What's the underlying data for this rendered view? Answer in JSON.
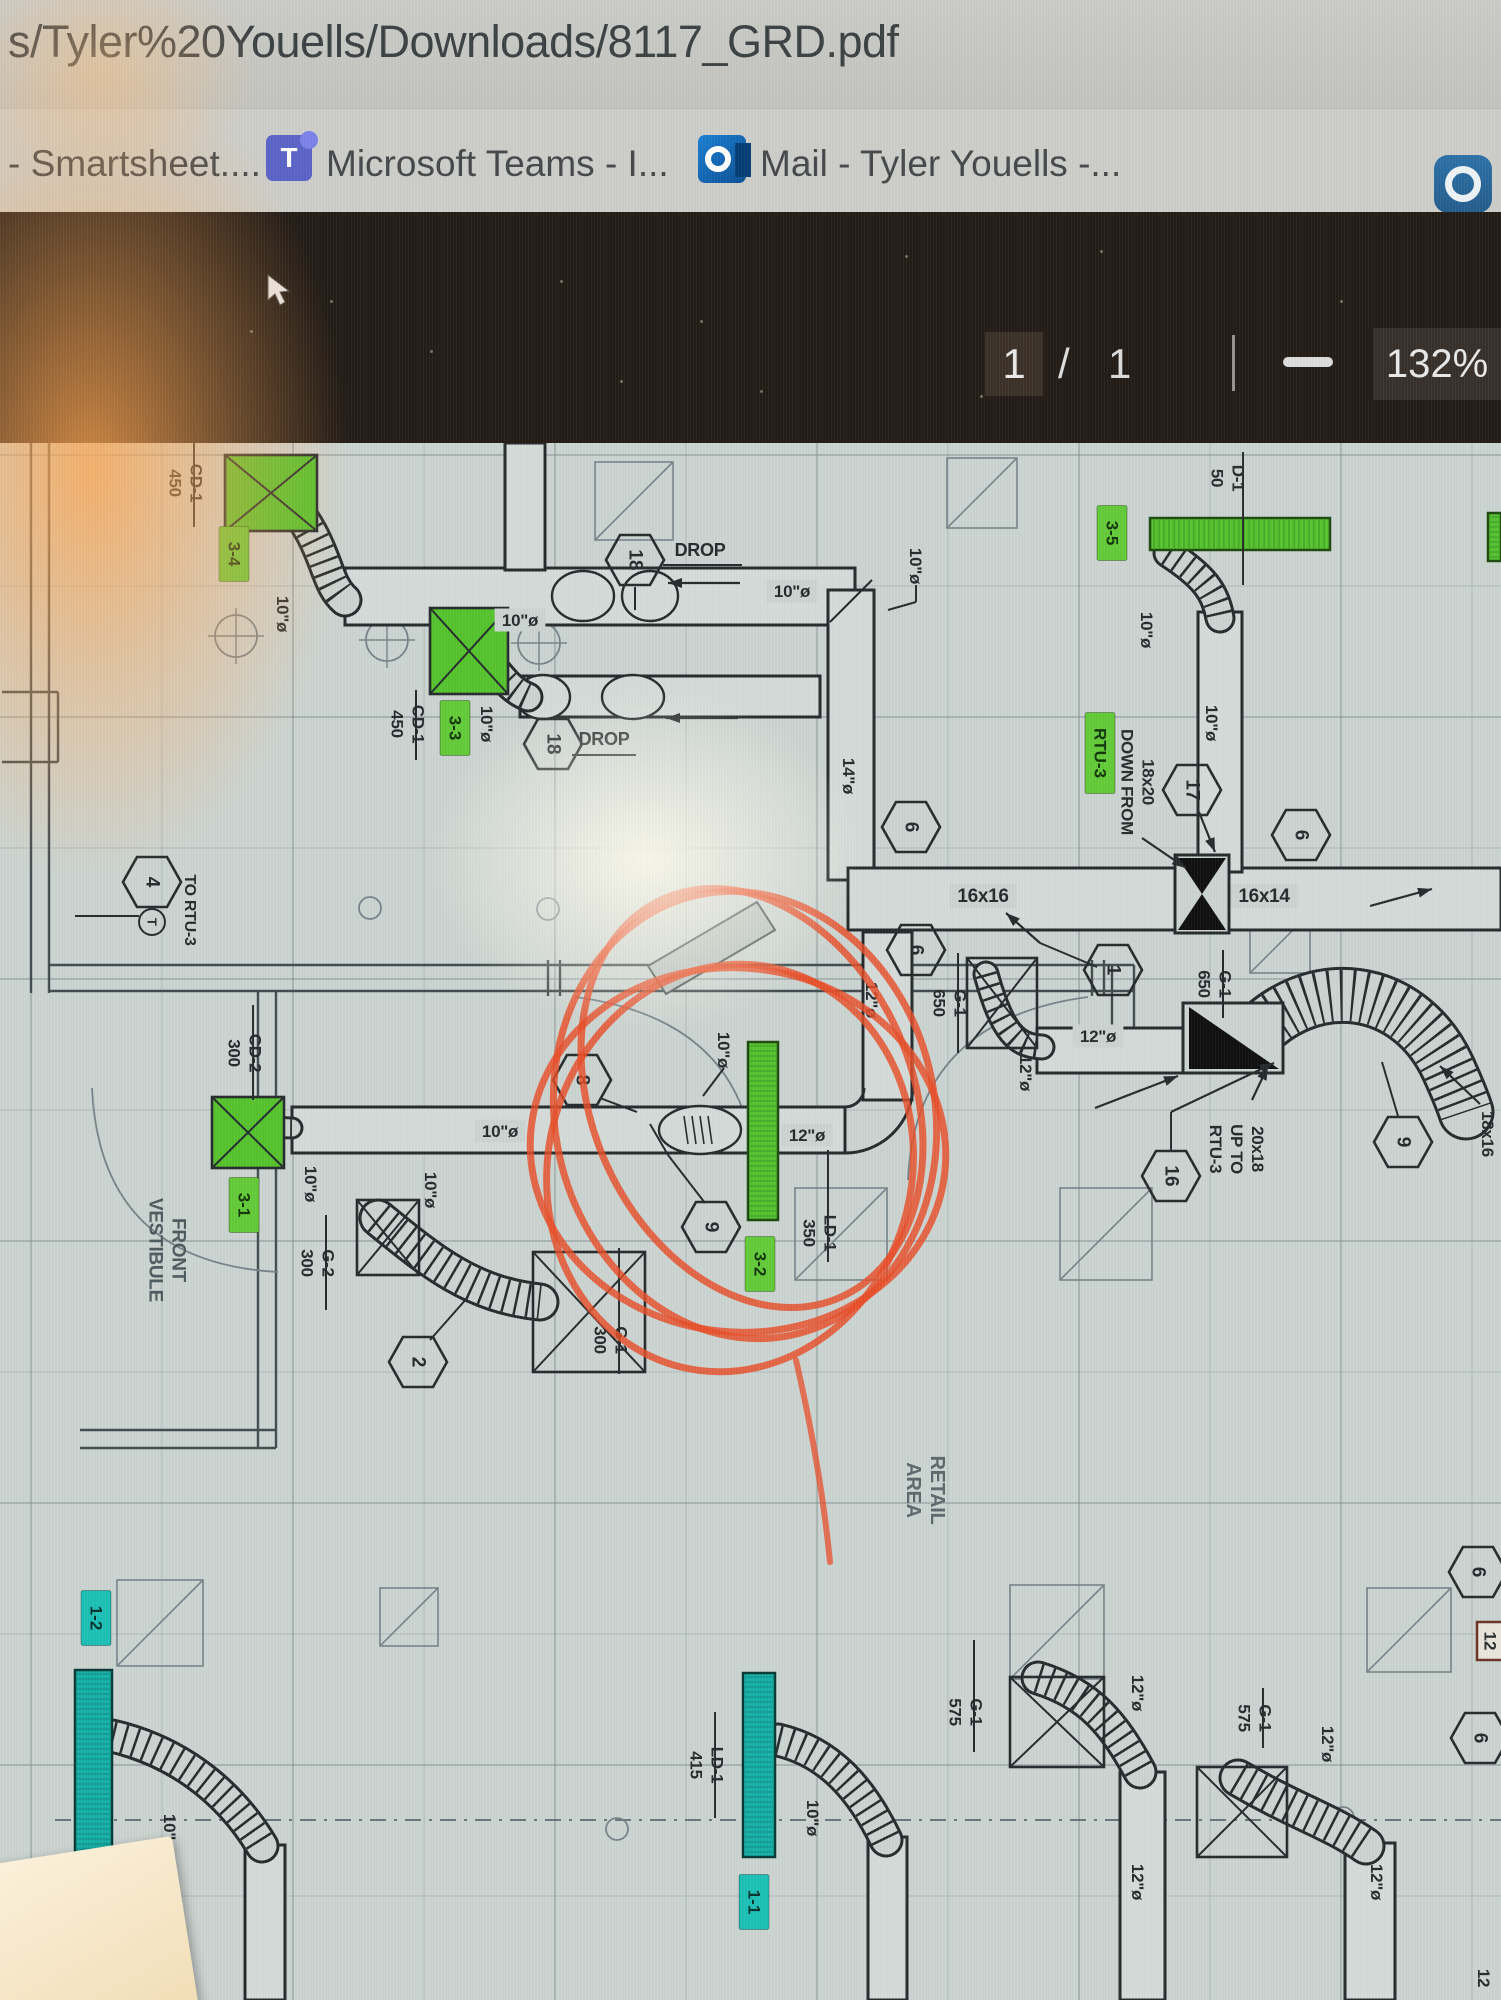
{
  "browser": {
    "url": "s/Tyler%20Youells/Downloads/8117_GRD.pdf"
  },
  "bookmarks": {
    "items": [
      {
        "label": "- Smartsheet....",
        "icon": "none"
      },
      {
        "label": "Microsoft Teams - I...",
        "icon": "teams-icon"
      },
      {
        "label": "Mail - Tyler Youells -...",
        "icon": "outlook-icon"
      }
    ],
    "right_icon": "app-ring-icon"
  },
  "pdf_toolbar": {
    "page_current": "1",
    "page_separator": "/",
    "page_total": "1",
    "zoom_out_label": "",
    "zoom_level": "132%"
  },
  "plan": {
    "colors": {
      "ink": "#262b2d",
      "paper": "#ccd4d1",
      "duct": "#d4dbd8",
      "green": "#55c32e",
      "greenChip": "#63cb39",
      "teal": "#16b1a8",
      "tealChip": "#1cc0b6",
      "red": "#e84e28",
      "gray": "#5c696d",
      "gray2": "#4d5a5e",
      "wall": "#414c4f",
      "grid": "#7d8b8e",
      "light": "#76848a"
    },
    "grid": {
      "x0": 31,
      "y0": 455,
      "step": 131,
      "nx": 12,
      "ny": 12
    },
    "labels": [
      {
        "t": "CD-1\n450",
        "x": 186,
        "y": 483,
        "r": 90,
        "dv": [
          441,
          527
        ]
      },
      {
        "t": "10\"ø",
        "x": 283,
        "y": 614,
        "r": 90
      },
      {
        "t": "DROP",
        "x": 700,
        "y": 550,
        "s": 18
      },
      {
        "t": "10\"ø",
        "x": 520,
        "y": 620,
        "bg": 1
      },
      {
        "t": "CD-1\n450",
        "x": 408,
        "y": 724,
        "r": 90,
        "dv": [
          690,
          760
        ]
      },
      {
        "t": "10\"ø",
        "x": 487,
        "y": 724,
        "r": 90
      },
      {
        "t": "DROP",
        "x": 604,
        "y": 739,
        "s": 18
      },
      {
        "t": "10\"ø",
        "x": 792,
        "y": 591,
        "bg": 1
      },
      {
        "t": "10\"ø",
        "x": 916,
        "y": 566,
        "r": 90
      },
      {
        "t": "14\"ø",
        "x": 849,
        "y": 776,
        "r": 90
      },
      {
        "t": "D-1\n50",
        "x": 1228,
        "y": 478,
        "r": 90
      },
      {
        "t": "10\"ø",
        "x": 1147,
        "y": 630,
        "r": 90
      },
      {
        "t": "10\"ø",
        "x": 1212,
        "y": 723,
        "r": 90
      },
      {
        "t": "18x20\nDOWN FROM",
        "x": 1138,
        "y": 782,
        "r": 90
      },
      {
        "t": "16x16",
        "x": 983,
        "y": 896,
        "s": 19,
        "bg": 1
      },
      {
        "t": "16x14",
        "x": 1264,
        "y": 896,
        "s": 19,
        "bg": 1
      },
      {
        "t": "G-1\n650",
        "x": 950,
        "y": 1003,
        "r": 90,
        "dv": [
          953,
          1053
        ]
      },
      {
        "t": "G-1\n650",
        "x": 1215,
        "y": 984,
        "r": 90,
        "dv": [
          950,
          1018
        ]
      },
      {
        "t": "12\"ø",
        "x": 1098,
        "y": 1036,
        "bg": 1
      },
      {
        "t": "12\"ø",
        "x": 1026,
        "y": 1073,
        "r": 90
      },
      {
        "t": "12\"ø",
        "x": 872,
        "y": 1000,
        "r": 90
      },
      {
        "t": "20x18\nUP TO\nRTU-3",
        "x": 1237,
        "y": 1149,
        "r": 90
      },
      {
        "t": "18x16",
        "x": 1488,
        "y": 1134,
        "r": 90
      },
      {
        "t": "TO RTU-3",
        "x": 190,
        "y": 910,
        "r": 90,
        "s": 16
      },
      {
        "t": "CD-2\n300",
        "x": 245,
        "y": 1053,
        "r": 90,
        "dv": [
          1005,
          1100
        ]
      },
      {
        "t": "FRONT\nVESTIBULE",
        "x": 167,
        "y": 1250,
        "r": 90,
        "s": 19,
        "c": "gray2"
      },
      {
        "t": "10\"ø",
        "x": 500,
        "y": 1131,
        "bg": 1
      },
      {
        "t": "10\"ø",
        "x": 311,
        "y": 1184,
        "r": 90
      },
      {
        "t": "G-2\n300",
        "x": 318,
        "y": 1263,
        "r": 90,
        "dv": [
          1215,
          1310
        ]
      },
      {
        "t": "10\"ø",
        "x": 431,
        "y": 1190,
        "r": 90
      },
      {
        "t": "10\"ø",
        "x": 724,
        "y": 1050,
        "r": 90
      },
      {
        "t": "12\"ø",
        "x": 807,
        "y": 1135,
        "bg": 1
      },
      {
        "t": "LD-1\n350",
        "x": 820,
        "y": 1233,
        "r": 90,
        "dv": [
          1150,
          1262
        ]
      },
      {
        "t": "G-1\n300",
        "x": 611,
        "y": 1340,
        "r": 90,
        "dv": [
          1248,
          1374
        ]
      },
      {
        "t": "RETAIL\nAREA",
        "x": 925,
        "y": 1490,
        "r": 90,
        "s": 20,
        "c": "gray"
      },
      {
        "t": "10\"ø",
        "x": 170,
        "y": 1832,
        "r": 90
      },
      {
        "t": "LD-1\n415",
        "x": 707,
        "y": 1765,
        "r": 90,
        "dv": [
          1712,
          1818
        ]
      },
      {
        "t": "10\"ø",
        "x": 813,
        "y": 1818,
        "r": 90
      },
      {
        "t": "G-1\n575",
        "x": 966,
        "y": 1712,
        "r": 90,
        "dv": [
          1640,
          1752
        ]
      },
      {
        "t": "12\"ø",
        "x": 1138,
        "y": 1693,
        "r": 90
      },
      {
        "t": "12\"ø",
        "x": 1138,
        "y": 1882,
        "r": 90
      },
      {
        "t": "G-1\n575",
        "x": 1255,
        "y": 1718,
        "r": 90,
        "dv": [
          1688,
          1748
        ]
      },
      {
        "t": "12\"ø",
        "x": 1328,
        "y": 1744,
        "r": 90
      },
      {
        "t": "12\"ø",
        "x": 1377,
        "y": 1882,
        "r": 90
      },
      {
        "t": "12",
        "x": 1484,
        "y": 1978,
        "r": 90
      }
    ],
    "chips": [
      {
        "t": "3-4",
        "x": 234,
        "y": 554
      },
      {
        "t": "3-3",
        "x": 455,
        "y": 728
      },
      {
        "t": "3-5",
        "x": 1112,
        "y": 533
      },
      {
        "t": "RTU-3",
        "x": 1100,
        "y": 753
      },
      {
        "t": "3-1",
        "x": 244,
        "y": 1205
      },
      {
        "t": "3-2",
        "x": 760,
        "y": 1264
      },
      {
        "t": "1-2",
        "x": 96,
        "y": 1618,
        "k": "teal"
      },
      {
        "t": "1-1",
        "x": 754,
        "y": 1902,
        "k": "teal"
      }
    ],
    "hexagons": [
      {
        "n": "18",
        "x": 635,
        "y": 560
      },
      {
        "n": "18",
        "x": 553,
        "y": 744
      },
      {
        "n": "17",
        "x": 1192,
        "y": 790
      },
      {
        "n": "6",
        "x": 1301,
        "y": 835
      },
      {
        "n": "6",
        "x": 911,
        "y": 827
      },
      {
        "n": "6",
        "x": 916,
        "y": 950
      },
      {
        "n": "1",
        "x": 1113,
        "y": 970
      },
      {
        "n": "16",
        "x": 1171,
        "y": 1176
      },
      {
        "n": "9",
        "x": 1403,
        "y": 1142
      },
      {
        "n": "4",
        "x": 152,
        "y": 882
      },
      {
        "n": "8",
        "x": 582,
        "y": 1080
      },
      {
        "n": "9",
        "x": 711,
        "y": 1227
      },
      {
        "n": "2",
        "x": 418,
        "y": 1362
      },
      {
        "n": "6",
        "x": 1480,
        "y": 1738
      },
      {
        "n": "6",
        "x": 1478,
        "y": 1572
      }
    ],
    "boxed_labels": [
      {
        "t": "12",
        "x": 1477,
        "y": 1622,
        "w": 26,
        "h": 38
      }
    ],
    "green_squares": [
      [
        225,
        455,
        92,
        76
      ],
      [
        430,
        608,
        78,
        86
      ],
      [
        212,
        1097,
        72,
        71
      ]
    ],
    "white_squares": [
      [
        967,
        958,
        70,
        90
      ],
      [
        357,
        1200,
        62,
        75
      ],
      [
        533,
        1252,
        112,
        120
      ],
      [
        1010,
        1677,
        94,
        90
      ],
      [
        1197,
        1767,
        90,
        90
      ]
    ],
    "green_bars": [
      [
        1150,
        518,
        180,
        32
      ],
      [
        1488,
        513,
        13,
        48
      ],
      [
        748,
        1042,
        30,
        178
      ]
    ],
    "teal_bars": [
      [
        75,
        1670,
        37,
        187
      ],
      [
        743,
        1673,
        32,
        184
      ]
    ],
    "ducts": [
      [
        345,
        568,
        510,
        57
      ],
      [
        520,
        676,
        300,
        41
      ],
      [
        828,
        590,
        46,
        290
      ],
      [
        848,
        868,
        653,
        62
      ],
      [
        1198,
        612,
        44,
        260
      ],
      [
        1037,
        1028,
        146,
        45
      ],
      [
        292,
        1107,
        553,
        46
      ],
      [
        863,
        932,
        49,
        168
      ],
      [
        245,
        1845,
        40,
        155
      ],
      [
        868,
        1837,
        39,
        163
      ],
      [
        1120,
        1772,
        45,
        228
      ],
      [
        1345,
        1843,
        50,
        157
      ],
      [
        505,
        443,
        40,
        127
      ]
    ],
    "elbow_paths": [
      "M845,1153 A68,68 0 0 0 913,1085",
      "M845,1107 A19,19 0 0 0 864,1088"
    ],
    "ovals": [
      [
        583,
        596,
        31,
        25
      ],
      [
        650,
        596,
        28,
        25
      ],
      [
        543,
        697,
        27,
        22
      ],
      [
        633,
        697,
        31,
        22
      ],
      [
        700,
        1130,
        41,
        24,
        1
      ]
    ],
    "flex": [
      {
        "d": "M282,492 C330,545 322,580 345,600",
        "w": 30
      },
      {
        "d": "M468,638 C498,668 505,688 528,697",
        "w": 26
      },
      {
        "d": "M1168,553 C1205,577 1215,592 1220,618",
        "w": 26
      },
      {
        "d": "M986,974 C1002,1032 1016,1046 1042,1047",
        "w": 22
      },
      {
        "d": "M378,1218 C432,1262 472,1295 540,1302",
        "w": 34
      },
      {
        "d": "M248,1112 C268,1126 278,1128 292,1128",
        "w": 18
      },
      {
        "d": "M1250,1040 C1310,972 1408,982 1448,1068 C1458,1090 1462,1100 1466,1112",
        "w": 52
      },
      {
        "d": "M112,1736 C172,1750 226,1786 262,1846",
        "w": 30
      },
      {
        "d": "M778,1740 C830,1752 862,1790 886,1840",
        "w": 30
      },
      {
        "d": "M1038,1678 C1090,1694 1114,1724 1140,1772",
        "w": 30
      },
      {
        "d": "M1238,1778 C1296,1812 1332,1822 1366,1846",
        "w": 34
      }
    ],
    "dampers": {
      "x_damper": [
        1175,
        855,
        54,
        78
      ],
      "tri_damper": [
        1183,
        1003,
        100,
        70
      ]
    },
    "arrows": [
      [
        1142,
        838,
        1186,
        868
      ],
      [
        1199,
        812,
        1215,
        852
      ],
      [
        1040,
        943,
        1006,
        913
      ],
      [
        1370,
        906,
        1432,
        889
      ],
      [
        1171,
        1112,
        1274,
        1063
      ],
      [
        1095,
        1108,
        1178,
        1076
      ],
      [
        1252,
        1100,
        1268,
        1066
      ],
      [
        1480,
        1104,
        1440,
        1066
      ],
      [
        740,
        583,
        668,
        583
      ],
      [
        738,
        718,
        666,
        718
      ]
    ],
    "lines": [
      [
        916,
        585,
        916,
        602
      ],
      [
        916,
        602,
        888,
        610
      ],
      [
        724,
        1068,
        703,
        1096
      ],
      [
        1243,
        452,
        1243,
        585
      ],
      [
        663,
        565,
        742,
        565
      ],
      [
        572,
        755,
        636,
        755
      ],
      [
        600,
        1098,
        637,
        1112
      ],
      [
        705,
        1203,
        668,
        1155
      ],
      [
        668,
        1155,
        650,
        1124
      ],
      [
        430,
        1340,
        468,
        1297
      ],
      [
        1398,
        1116,
        1382,
        1062
      ],
      [
        75,
        916,
        139,
        916
      ],
      [
        830,
        622,
        872,
        580
      ],
      [
        1097,
        967,
        1040,
        943
      ],
      [
        1171,
        1150,
        1171,
        1112
      ],
      [
        635,
        587,
        635,
        610
      ]
    ],
    "walls": [
      [
        31,
        443,
        31,
        993
      ],
      [
        49,
        443,
        49,
        993
      ],
      [
        49,
        965,
        1134,
        965
      ],
      [
        49,
        991,
        1134,
        991
      ],
      [
        1112,
        965,
        1112,
        1040
      ],
      [
        1134,
        965,
        1134,
        1040
      ],
      [
        258,
        991,
        258,
        1448
      ],
      [
        276,
        991,
        276,
        1448
      ],
      [
        80,
        1430,
        276,
        1430
      ],
      [
        80,
        1448,
        276,
        1448
      ],
      [
        548,
        960,
        548,
        996
      ],
      [
        560,
        960,
        560,
        996
      ],
      [
        1092,
        960,
        1092,
        996
      ],
      [
        1104,
        960,
        1104,
        996
      ],
      [
        2,
        692,
        58,
        692
      ],
      [
        2,
        762,
        58,
        762
      ],
      [
        58,
        692,
        58,
        762
      ]
    ],
    "door_arcs": [
      "M575,997 Q750,1020 756,1180",
      "M1088,997 Q915,1020 908,1180",
      "M92,1088 Q100,1262 278,1272"
    ],
    "columns": [
      [
        236,
        636
      ],
      [
        387,
        640
      ],
      [
        539,
        643
      ]
    ],
    "small_circles": [
      [
        370,
        908
      ],
      [
        548,
        909
      ],
      [
        617,
        1829
      ],
      [
        1343,
        1818
      ]
    ],
    "diag_squares": [
      [
        595,
        462,
        78
      ],
      [
        947,
        458,
        70
      ],
      [
        117,
        1580,
        86
      ],
      [
        380,
        1588,
        58
      ],
      [
        1010,
        1585,
        94
      ],
      [
        1367,
        1588,
        84
      ],
      [
        795,
        1188,
        92
      ],
      [
        1060,
        1188,
        92
      ],
      [
        1250,
        913,
        60
      ]
    ],
    "dashed": [
      [
        55,
        1820,
        1501,
        1820
      ]
    ],
    "gray_poly": "648,966 757,902 775,930 666,994",
    "thermostat": {
      "x": 152,
      "y": 922,
      "r": 13,
      "t": "T"
    },
    "red_annotation": {
      "ellipses": [
        [
          745,
          1115,
          190,
          225,
          -12
        ],
        [
          738,
          1150,
          208,
          182,
          6
        ],
        [
          752,
          1098,
          160,
          218,
          -24
        ],
        [
          730,
          1168,
          182,
          205,
          14
        ]
      ],
      "tail": "M796,1360 C812,1430 824,1500 830,1562"
    }
  }
}
